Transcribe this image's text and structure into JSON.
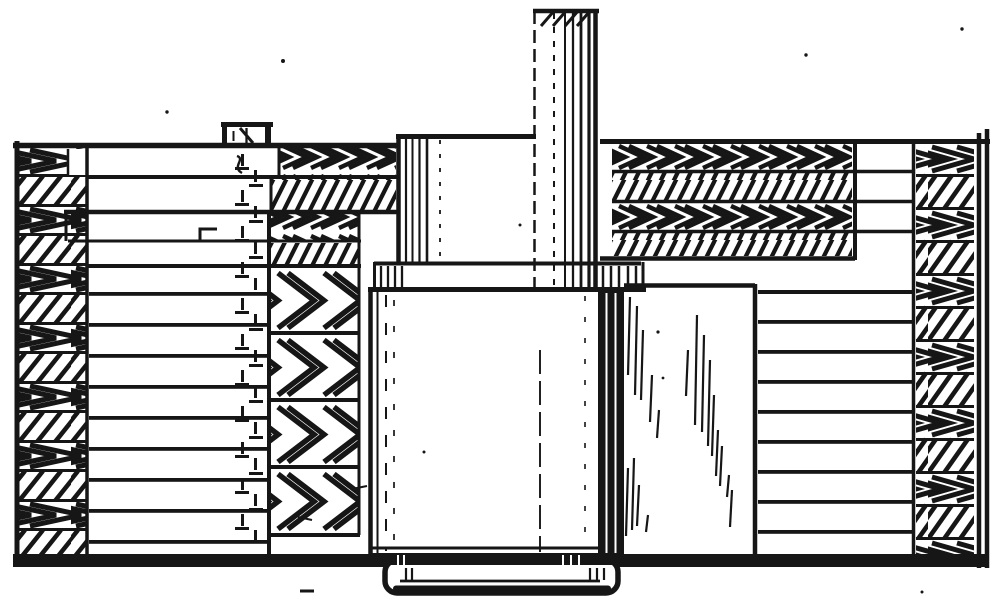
{
  "meta": {
    "kind": "technical-line-drawing",
    "description": "Patent-style black-and-white cross-section drawing of a cylindrical plunger assembly: a central shaft and cylinder with flange collar and foot, clamped between laminated stacks, herringbone-hatched clamp columns, a hidden dashed clamping bolt, and a thick base plate",
    "paper_color": "#ffffff",
    "ink_color": "#161616"
  },
  "figure": {
    "width": 1002,
    "height": 600,
    "visible_text": [],
    "hatch_styles": [
      "herringbone-chevron",
      "steep-diagonal-hatch",
      "horizontal-lamination-lines",
      "vertical-cylinder-shading",
      "hidden-dashed-line"
    ],
    "components": [
      {
        "id": "plunger-shaft",
        "label": "upper plunger shaft with hatched cap"
      },
      {
        "id": "upper-column",
        "label": "upper cylinder section"
      },
      {
        "id": "flange-collar",
        "label": "flange collar ring"
      },
      {
        "id": "main-cylinder",
        "label": "main cylinder body"
      },
      {
        "id": "cylinder-foot",
        "label": "cylinder foot below base line"
      },
      {
        "id": "side-block",
        "label": "polished side block with reflection streaks"
      },
      {
        "id": "left-clamp-column",
        "label": "left herringbone clamp column"
      },
      {
        "id": "left-end-plates",
        "label": "stepped end plates"
      },
      {
        "id": "inner-clamp-column",
        "label": "inner herringbone clamp column"
      },
      {
        "id": "left-laminations",
        "label": "left lamination stack"
      },
      {
        "id": "hidden-bolt",
        "label": "hidden clamping bolt centre line"
      },
      {
        "id": "bolt-stud",
        "label": "small stud cap on top plate"
      },
      {
        "id": "right-hatch-bands",
        "label": "right herringbone band stack"
      },
      {
        "id": "right-laminations",
        "label": "right lamination stack"
      },
      {
        "id": "right-clamp-column",
        "label": "right herringbone clamp column"
      },
      {
        "id": "right-wall",
        "label": "right edge wall"
      },
      {
        "id": "base-plate",
        "label": "base plate line"
      }
    ]
  }
}
